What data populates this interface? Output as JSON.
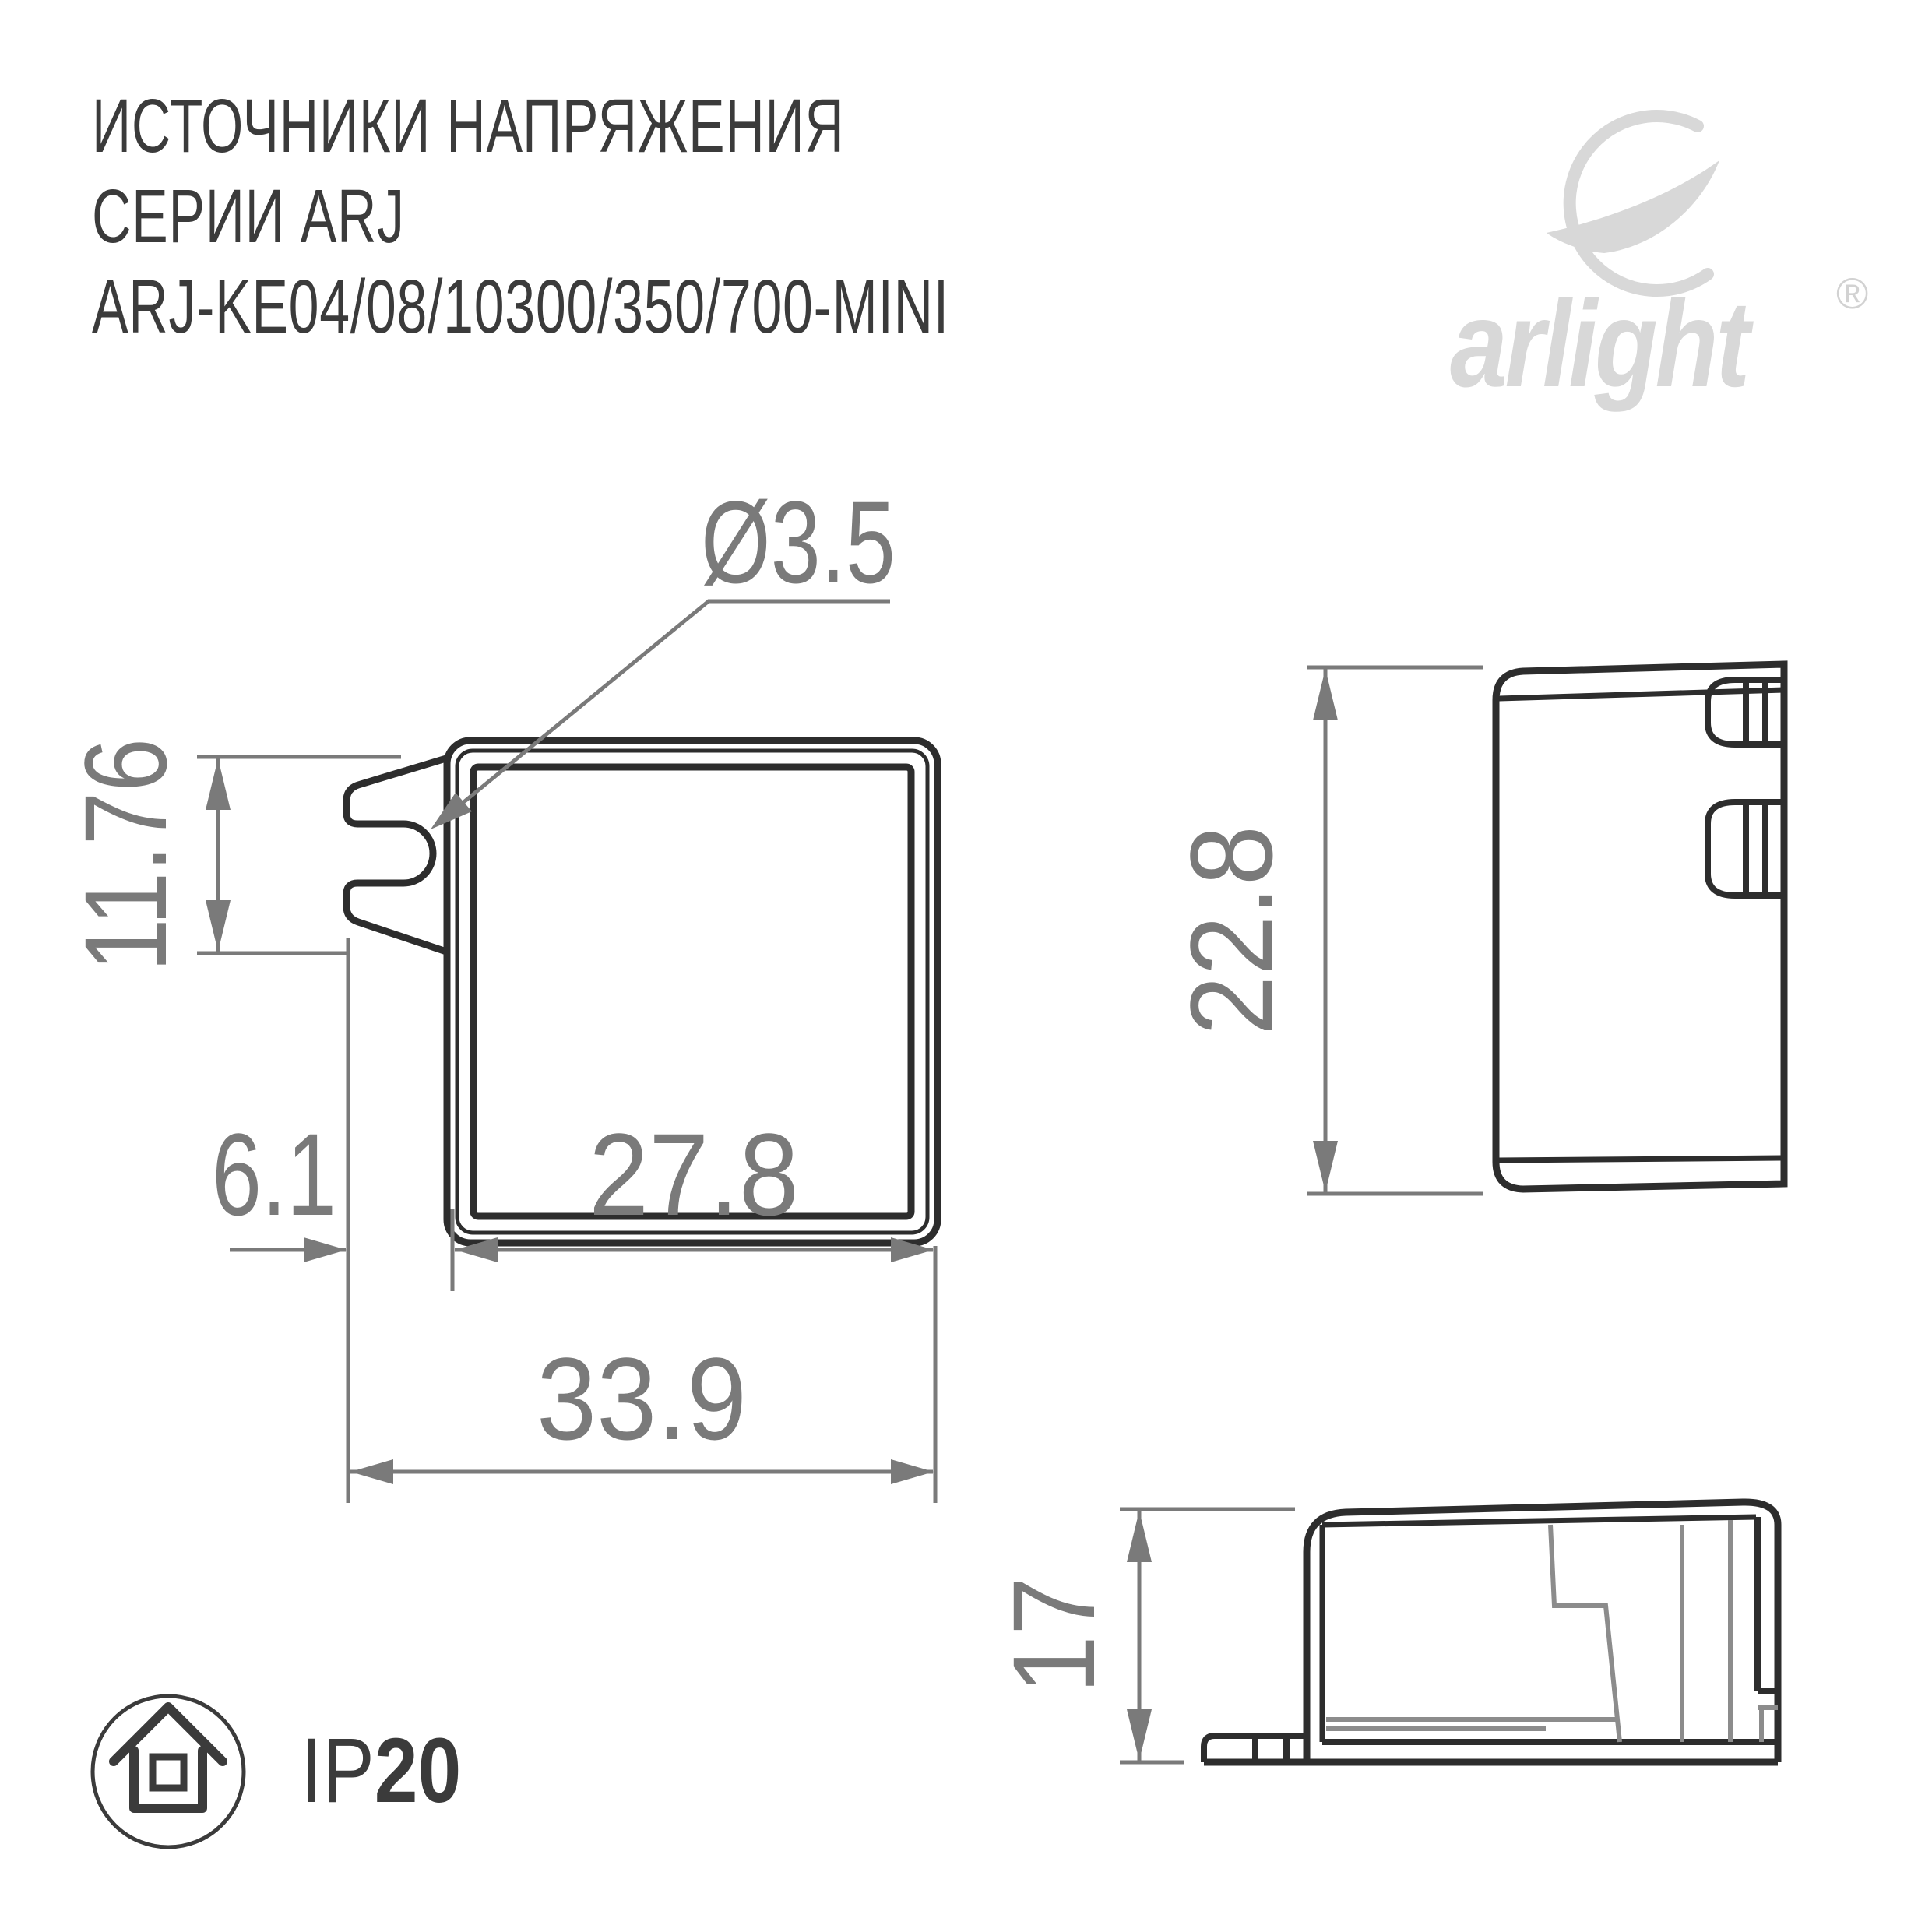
{
  "title": {
    "line1": "ИСТОЧНИКИ НАПРЯЖЕНИЯ",
    "line2": "СЕРИИ ARJ",
    "line3": "ARJ-KE04/08/10300/350/700-MINI"
  },
  "logo": {
    "wordmark": "arlight",
    "registered": "®"
  },
  "drawing": {
    "front_view": {
      "hole_diameter": "Ø3.5",
      "tab_height": "11.76",
      "tab_offset": "6.1",
      "body_width": "27.8",
      "overall_width": "33.9"
    },
    "side_view": {
      "height": "22.8"
    },
    "profile_view": {
      "height": "17"
    }
  },
  "ip_rating": {
    "prefix": "IP",
    "value": "20"
  },
  "colors": {
    "line_dark": "#2d2d2d",
    "dimension_gray": "#7a7a7a",
    "interior_gray": "#8c8c8c",
    "logo_gray": "#d8d8d8",
    "text_dark": "#3b3b3b"
  }
}
